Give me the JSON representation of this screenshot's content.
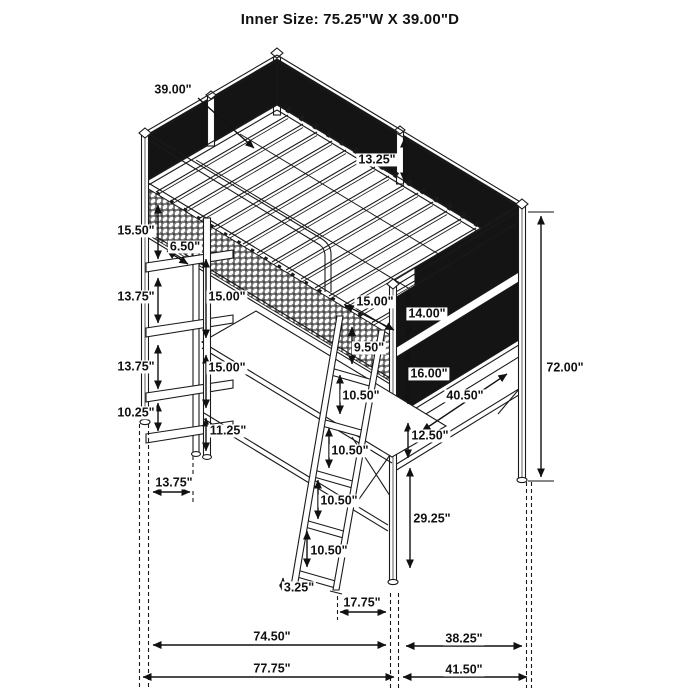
{
  "title": "Inner Size: 75.25\"W X 39.00\"D",
  "figure": {
    "type": "isometric-dimension-drawing",
    "subject": "metal loft bed with desk, side shelves and angled ladder",
    "background_color": "#ffffff",
    "line_color": "#1a1a1a",
    "mesh_panel_color": "#141414",
    "units": "inches"
  },
  "dimension_labels": [
    {
      "id": "inner-depth",
      "text": "39.00\"",
      "x": 173,
      "y": 90
    },
    {
      "id": "guardrail-height",
      "text": "13.25\"",
      "x": 377,
      "y": 160
    },
    {
      "id": "shelf-gap-1",
      "text": "15.50\"",
      "x": 136,
      "y": 231
    },
    {
      "id": "shelf-depth",
      "text": "6.50\"",
      "x": 185,
      "y": 247
    },
    {
      "id": "shelf-gap-2",
      "text": "13.75\"",
      "x": 136,
      "y": 297
    },
    {
      "id": "desk-clearance-upper",
      "text": "15.00\"",
      "x": 227,
      "y": 297
    },
    {
      "id": "shelf-gap-3",
      "text": "13.75\"",
      "x": 136,
      "y": 367
    },
    {
      "id": "desk-clearance-lower",
      "text": "15.00\"",
      "x": 227,
      "y": 368
    },
    {
      "id": "shelf-gap-4",
      "text": "10.25\"",
      "x": 136,
      "y": 413
    },
    {
      "id": "desk-leg-height",
      "text": "11.25\"",
      "x": 228,
      "y": 431
    },
    {
      "id": "ladder-opening",
      "text": "15.00\"",
      "x": 375,
      "y": 302
    },
    {
      "id": "right-panel-upper",
      "text": "14.00\"",
      "x": 427,
      "y": 314
    },
    {
      "id": "ladder-top-gap",
      "text": "9.50\"",
      "x": 369,
      "y": 348
    },
    {
      "id": "right-panel-lower",
      "text": "16.00\"",
      "x": 429,
      "y": 374
    },
    {
      "id": "ladder-rung-gap-1",
      "text": "10.50\"",
      "x": 361,
      "y": 396
    },
    {
      "id": "right-desk-length",
      "text": "40.50\"",
      "x": 465,
      "y": 396
    },
    {
      "id": "desk-to-shelf",
      "text": "12.50\"",
      "x": 430,
      "y": 436
    },
    {
      "id": "ladder-rung-gap-2",
      "text": "10.50\"",
      "x": 350,
      "y": 451
    },
    {
      "id": "ladder-rung-gap-3",
      "text": "10.50\"",
      "x": 339,
      "y": 501
    },
    {
      "id": "right-leg-height",
      "text": "29.25\"",
      "x": 432,
      "y": 519
    },
    {
      "id": "ladder-rung-gap-4",
      "text": "10.50\"",
      "x": 329,
      "y": 551
    },
    {
      "id": "overall-height",
      "text": "72.00\"",
      "x": 565,
      "y": 368
    },
    {
      "id": "ladder-foot",
      "text": "3.25\"",
      "x": 299,
      "y": 588
    },
    {
      "id": "shelf-unit-depth",
      "text": "13.75\"",
      "x": 174,
      "y": 483
    },
    {
      "id": "ladder-bottom-offset",
      "text": "17.75\"",
      "x": 362,
      "y": 603
    },
    {
      "id": "floor-width-inner",
      "text": "74.50\"",
      "x": 272,
      "y": 637
    },
    {
      "id": "floor-depth-inner",
      "text": "38.25\"",
      "x": 464,
      "y": 639
    },
    {
      "id": "floor-width-outer",
      "text": "77.75\"",
      "x": 272,
      "y": 669
    },
    {
      "id": "floor-depth-outer",
      "text": "41.50\"",
      "x": 464,
      "y": 670
    }
  ]
}
